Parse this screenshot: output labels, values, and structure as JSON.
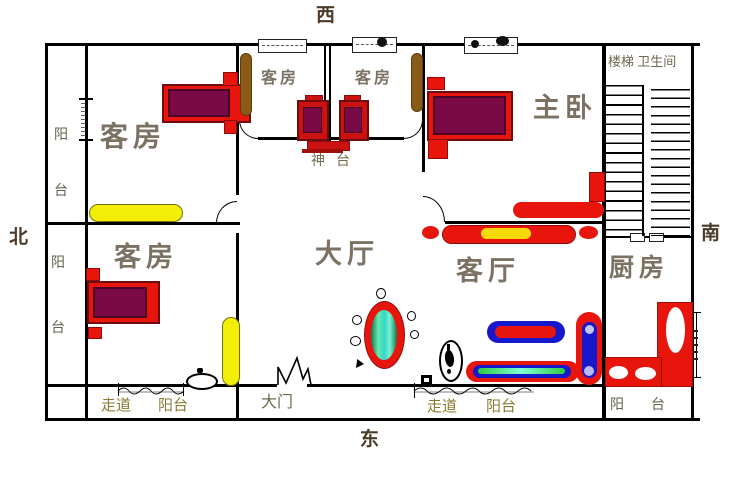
{
  "compass": {
    "west": "西",
    "north": "北",
    "south": "南",
    "east": "东"
  },
  "rooms": {
    "guest_top_left": "客房",
    "guest_mid_left": "客房",
    "guest_mid_right": "客房",
    "master_bedroom": "主卧",
    "stairs_bathroom": "楼梯 卫生间",
    "guest_bottom_left": "客房",
    "hall": "大厅",
    "living_room": "客厅",
    "kitchen": "厨房"
  },
  "labels": {
    "altar": "神台",
    "balcony_yang": "阳",
    "balcony_tai": "台",
    "balcony": "阳台",
    "corridor": "走道",
    "main_door": "大门"
  },
  "colors": {
    "wall": "#000000",
    "furniture_red": "#e8150d",
    "mattress_maroon": "#7a0a45",
    "wardrobe_brown": "#8a5a17",
    "rug_yellow": "#f2ee08",
    "cushion_yellow": "#f5d908",
    "sofa_blue": "#1717cc",
    "tank_green": "#35dfa0",
    "label_gray": "#7b7264",
    "label_olive": "#8a7a30"
  }
}
